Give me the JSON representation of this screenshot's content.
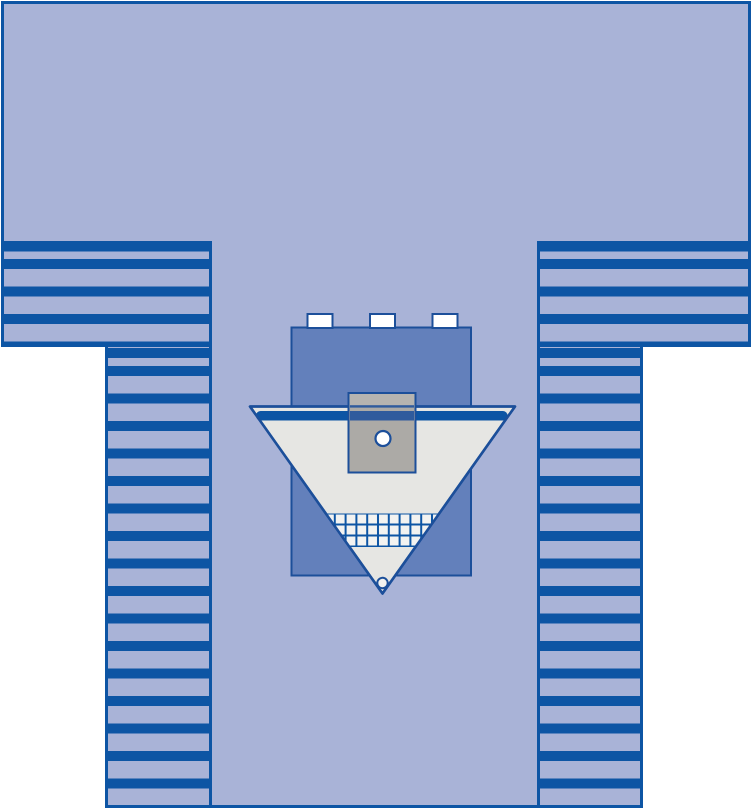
{
  "colors": {
    "white": "#ffffff",
    "drape": "#a9b3d7",
    "navy": "#0d55a4",
    "outline": "#1c4f9a",
    "armboard": "#6380bb",
    "pouch": "#e6e6e3",
    "pocket": "#acaaa6",
    "pocket_top": "#b6b4b0",
    "pocket_band": "#2f5b9d",
    "grid_cell": "#f3f3f1",
    "apex_fill": "#f2f2ef",
    "tab": "#ffffff"
  },
  "illustration": {
    "kind": "surgical-drape-product-diagram",
    "parts": [
      "drape-top-sheet",
      "drape-left-sleeve-striped",
      "drape-right-sleeve-striped",
      "drape-left-leg-striped",
      "drape-right-leg-striped",
      "drape-center-panel",
      "armboard-cover",
      "adhesive-tab",
      "incise-band",
      "fluid-pouch-triangle",
      "translucent-pocket",
      "pocket-port-hole",
      "mesh-instrument-pad",
      "apex-drain-hole"
    ],
    "adhesive_tab_count": 3,
    "stripes": {
      "period_px": 27.5,
      "navy_band_px": 10,
      "sleeve_phase_px": 15,
      "leg_phase_px": 19
    },
    "mesh_grid": {
      "rows": 3,
      "cell_px": 11
    }
  }
}
